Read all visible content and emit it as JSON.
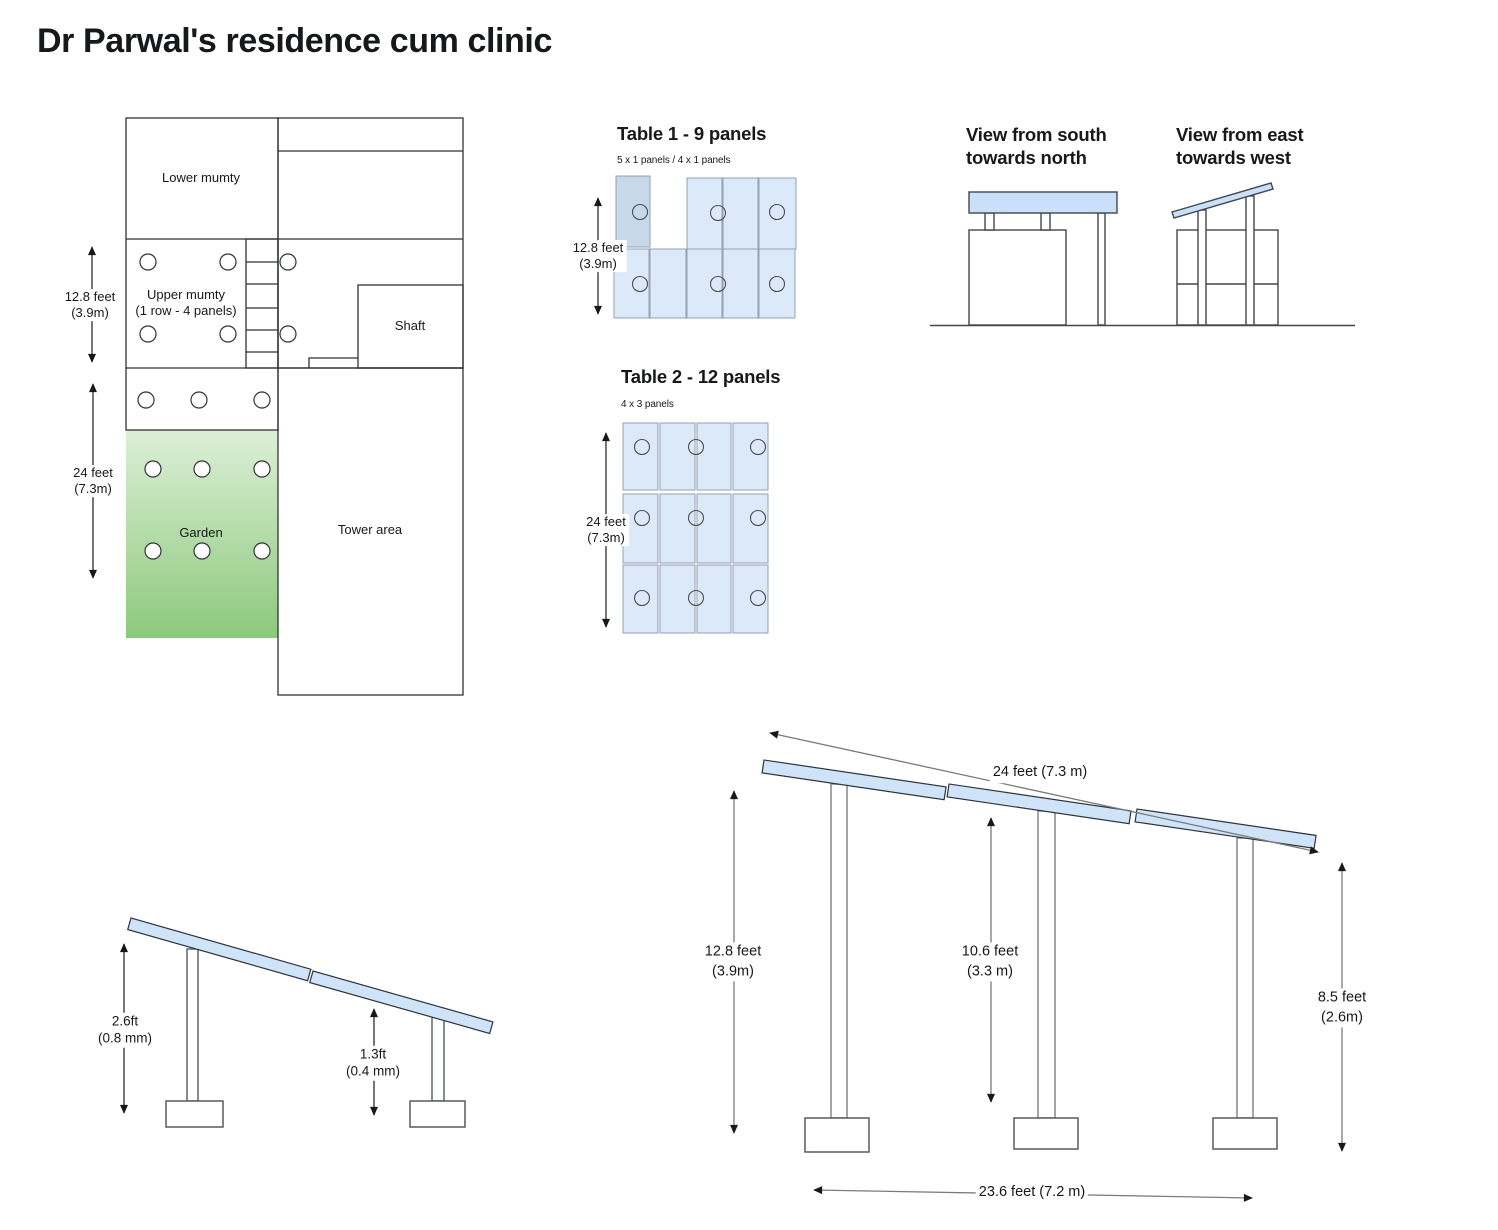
{
  "title": "Dr Parwal's residence cum clinic",
  "colors": {
    "panel_blue": "#dce9f8",
    "panel_blue_dark": "#c6d8ea",
    "panel_stroke": "#93a1b0",
    "view_panel_blue": "#c9e0f8",
    "elevation_panel_blue": "#cfe3f9",
    "garden_green_top": "#dcefd6",
    "garden_green_bottom": "#8cc97c",
    "ink": "#17181a",
    "plan_line": "#2f3237"
  },
  "floor_plan": {
    "lower_mumty": "Lower mumty",
    "upper_mumty": "Upper mumty\n(1 row - 4 panels)",
    "shaft": "Shaft",
    "garden": "Garden",
    "tower_area": "Tower area",
    "mumty_height": "12.8 feet\n(3.9m)",
    "garden_height": "24 feet\n(7.3m)"
  },
  "table1": {
    "title": "Table 1 - 9 panels",
    "subtitle": "5 x 1 panels / 4 x 1 panels",
    "panel_count": 9,
    "height": "12.8 feet\n(3.9m)"
  },
  "table2": {
    "title": "Table 2 - 12 panels",
    "subtitle": "4 x 3 panels",
    "panel_count": 12,
    "height": "24 feet\n(7.3m)"
  },
  "views": {
    "south_title": "View from south\ntowards north",
    "east_title": "View from east\ntowards west"
  },
  "mount_detail": {
    "front_leg": "2.6ft\n(0.8 mm)",
    "rear_leg": "1.3ft\n(0.4 mm)"
  },
  "elevation": {
    "panel_span": "24 feet (7.3 m)",
    "left_height": "12.8 feet\n(3.9m)",
    "middle_height": "10.6 feet\n(3.3 m)",
    "right_height": "8.5 feet\n(2.6m)",
    "base_span": "23.6 feet (7.2 m)"
  }
}
